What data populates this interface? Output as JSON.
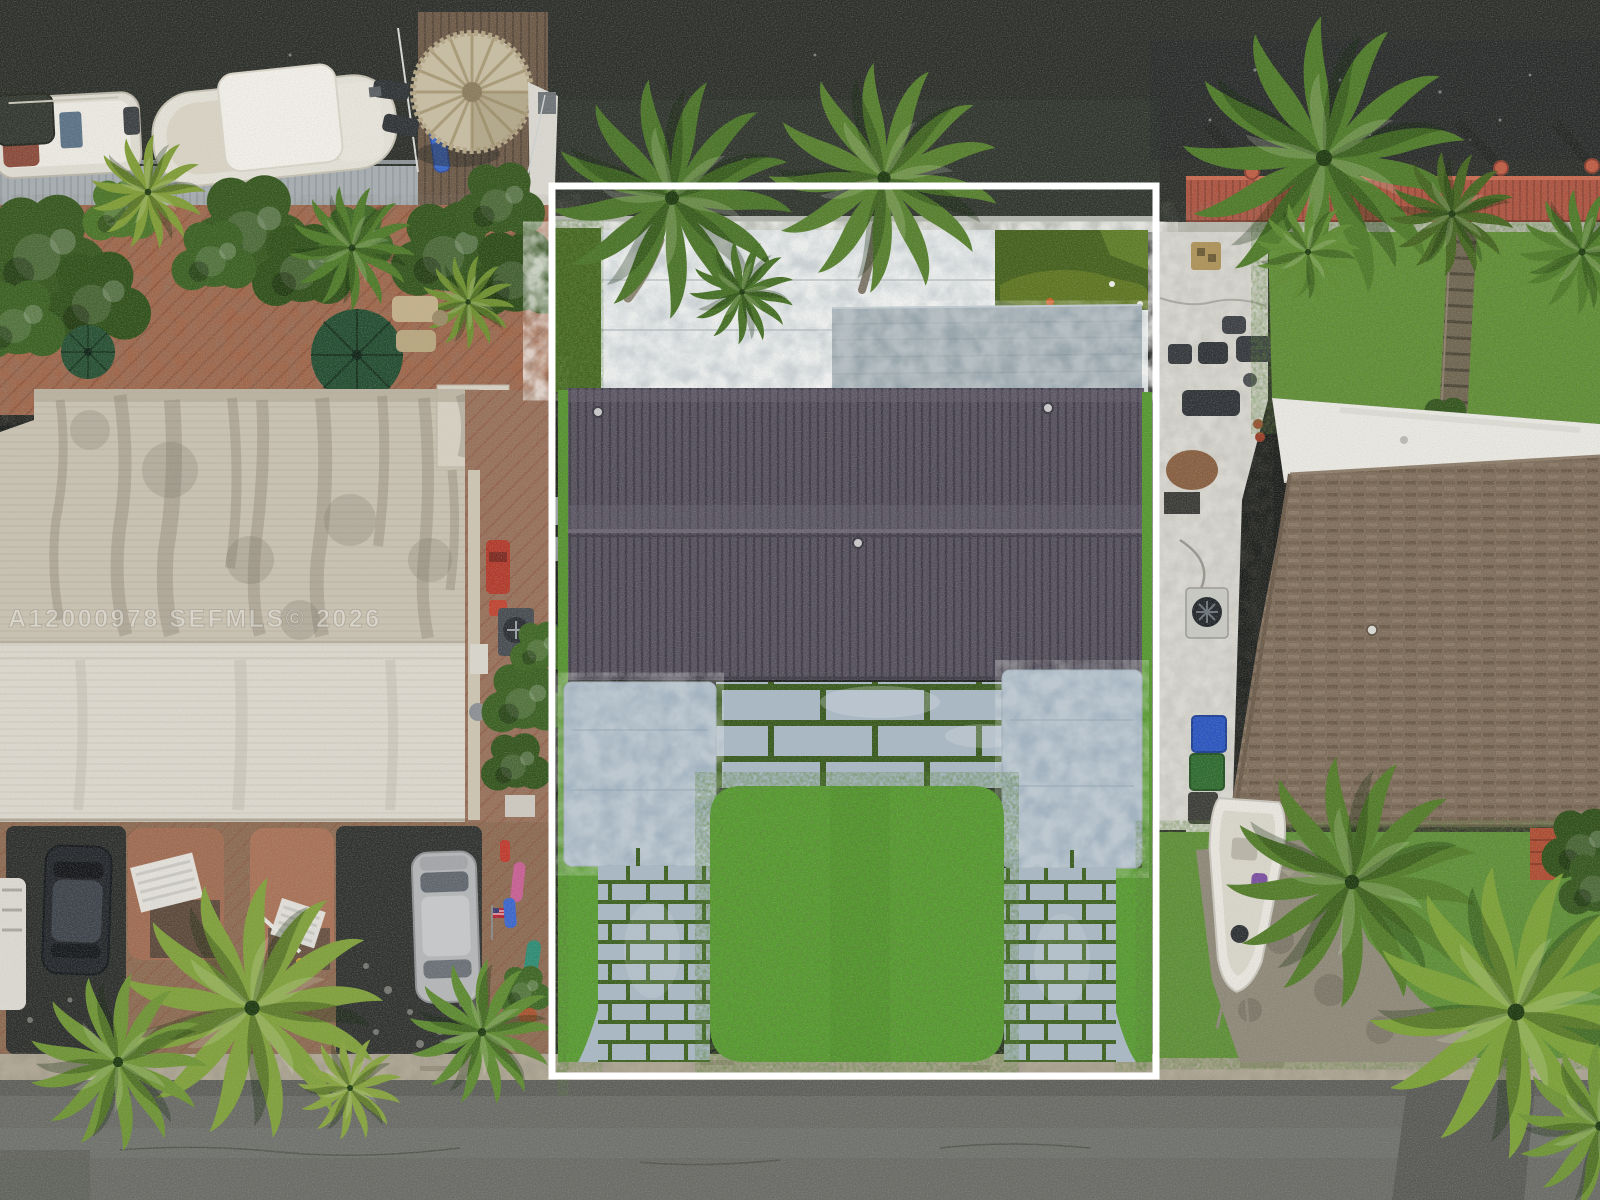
{
  "image": {
    "kind": "aerial-drone-real-estate-photo",
    "watermark": {
      "text": "A12000978  SEFMLS© 2026"
    },
    "highlight": {
      "border_color": "#ffffff"
    },
    "colors": {
      "water": "#2c2f2a",
      "left_dock": "#a6adb1",
      "red_dock": "#ad5340",
      "tiki_thatch": "#c7bda2",
      "brick_patio": "#a06548",
      "white_roof_upper": "#c9c2b2",
      "white_roof_lower": "#dcd8ce",
      "metal_roof": "#56515d",
      "flat_roof": "#97a5ad",
      "marble_patio": "#ccd3d6",
      "carport_pad": "#a2b3c1",
      "paver_joint_green": "#3a5c20",
      "lawn": "#55a02c",
      "right_lawn": "#619133",
      "dark_turf": "#3f6119",
      "brown_roof": "#7d6c5a",
      "right_white_roof": "#e9e8e2",
      "asphalt_pad": "#2d2f2c",
      "curb": "#b0a794",
      "road": "#6a6b66"
    },
    "scene_labels": [
      "canal water",
      "boats",
      "tiki hut",
      "docks",
      "palm trees",
      "left house white roof",
      "center house metal roof",
      "paver driveways",
      "center lawn",
      "right house brown shingle roof",
      "parked cars",
      "road",
      "highlight rectangle",
      "watermark"
    ]
  }
}
